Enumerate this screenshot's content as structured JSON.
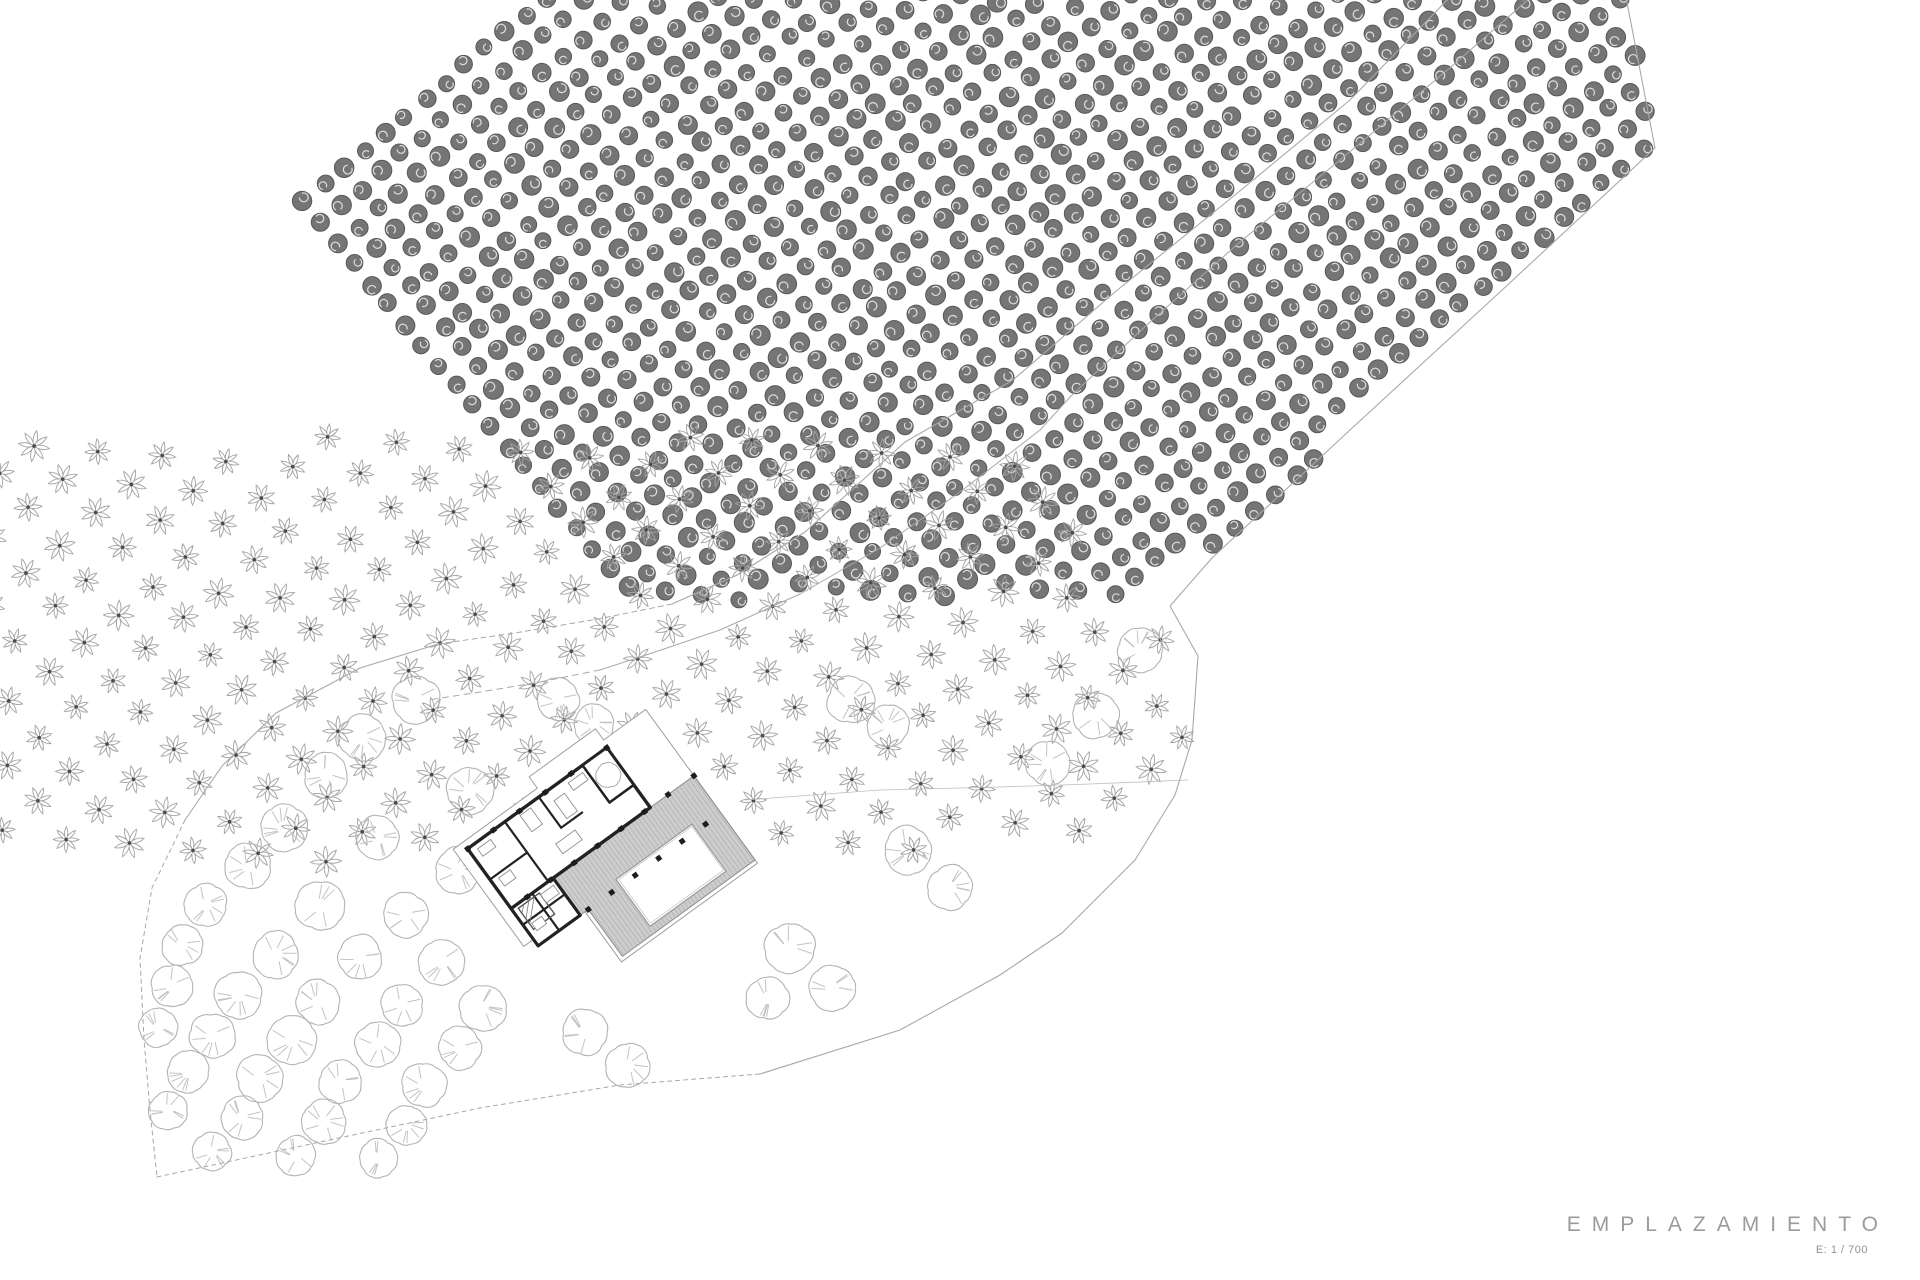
{
  "titleblock": {
    "title": "EMPLAZAMIENTO",
    "scale_label": "E: 1 / 700"
  },
  "drawing": {
    "canvas": {
      "width": 1920,
      "height": 1280,
      "background": "#ffffff"
    },
    "colors": {
      "boundary": "#a8a8a8",
      "road": "#a8a8a8",
      "fence": "#bdbdbd",
      "round_tree": "#b3b3b3",
      "round_tree_tick": "#c3c3c3",
      "flower_petal": "#a3a3a3",
      "flower_center": "#4a4a4a",
      "dark_tree_fill": "#757575",
      "dark_tree_stroke": "#585858",
      "dark_tree_texture": "#ffffff",
      "wall": "#222222",
      "plot_outline": "#9f9f9f",
      "deck_fill": "#cdcdcd",
      "deck_stripe": "#b7b7b7",
      "deck_edge": "#8a8a8a",
      "pool_edge": "#9a9a9a",
      "furniture": "#8f8f8f",
      "column": "#1d1d1d"
    },
    "site_boundary": {
      "solid_upper": [
        [
          1455,
          -8
        ],
        [
          1350,
          100
        ],
        [
          1235,
          195
        ],
        [
          1115,
          292
        ],
        [
          1013,
          380
        ],
        [
          905,
          442
        ],
        [
          805,
          532
        ],
        [
          737,
          575
        ],
        [
          672,
          604
        ]
      ],
      "dashed_mid": [
        [
          672,
          604
        ],
        [
          598,
          619
        ],
        [
          515,
          633
        ],
        [
          438,
          644
        ]
      ],
      "solid_blob_top": [
        [
          438,
          644
        ],
        [
          360,
          668
        ],
        [
          276,
          713
        ],
        [
          222,
          766
        ],
        [
          185,
          820
        ]
      ],
      "dashed_left": [
        [
          185,
          820
        ],
        [
          152,
          888
        ],
        [
          140,
          958
        ],
        [
          144,
          1040
        ],
        [
          150,
          1110
        ],
        [
          157,
          1177
        ]
      ],
      "dashed_bottom": [
        [
          157,
          1177
        ],
        [
          320,
          1142
        ],
        [
          480,
          1108
        ],
        [
          620,
          1085
        ],
        [
          760,
          1074
        ]
      ],
      "solid_right": [
        [
          760,
          1074
        ],
        [
          900,
          1030
        ],
        [
          1000,
          975
        ],
        [
          1062,
          933
        ],
        [
          1135,
          860
        ],
        [
          1175,
          795
        ],
        [
          1192,
          740
        ],
        [
          1198,
          656
        ],
        [
          1170,
          606
        ],
        [
          1212,
          558
        ],
        [
          1350,
          430
        ],
        [
          1500,
          292
        ],
        [
          1655,
          148
        ],
        [
          1625,
          -8
        ]
      ]
    },
    "road": {
      "lower_solid": [
        [
          1537,
          -8
        ],
        [
          1445,
          72
        ],
        [
          1340,
          160
        ],
        [
          1240,
          242
        ],
        [
          1150,
          322
        ],
        [
          1072,
          395
        ],
        [
          1040,
          430
        ],
        [
          960,
          492
        ],
        [
          880,
          548
        ],
        [
          800,
          594
        ],
        [
          720,
          630
        ],
        [
          655,
          652
        ],
        [
          600,
          670
        ]
      ],
      "lower_dashed": [
        [
          600,
          670
        ],
        [
          540,
          682
        ],
        [
          480,
          692
        ],
        [
          428,
          700
        ]
      ]
    },
    "fence_line": [
      [
        745,
        800
      ],
      [
        880,
        790
      ],
      [
        1000,
        787
      ],
      [
        1090,
        784
      ],
      [
        1188,
        780
      ]
    ],
    "orchards": [
      {
        "name": "dense-dark-grove",
        "symbol": "dark",
        "spacing": 26.5,
        "angle": -40,
        "radius": 9,
        "jitter": 2.5,
        "region": [
          [
            1537,
            -12
          ],
          [
            1625,
            -12
          ],
          [
            1658,
            148
          ],
          [
            1500,
            292
          ],
          [
            1350,
            430
          ],
          [
            1215,
            552
          ],
          [
            1108,
            600
          ],
          [
            1040,
            430
          ],
          [
            1072,
            395
          ],
          [
            1150,
            322
          ],
          [
            1240,
            242
          ],
          [
            1340,
            160
          ],
          [
            1445,
            72
          ]
        ]
      },
      {
        "name": "flowering-grove",
        "symbol": "flower",
        "spacing": 46,
        "angle": -40,
        "radius": 14,
        "jitter": 3,
        "region": [
          [
            1040,
            432
          ],
          [
            1100,
            588
          ],
          [
            1185,
            646
          ],
          [
            1186,
            738
          ],
          [
            1148,
            798
          ],
          [
            1050,
            845
          ],
          [
            920,
            862
          ],
          [
            800,
            856
          ],
          [
            745,
            826
          ],
          [
            700,
            778
          ],
          [
            640,
            718
          ],
          [
            560,
            690
          ],
          [
            545,
            660
          ],
          [
            620,
            640
          ],
          [
            700,
            612
          ],
          [
            780,
            582
          ],
          [
            860,
            548
          ],
          [
            950,
            500
          ]
        ]
      }
    ],
    "scattered_trees": [
      [
        416,
        700,
        32
      ],
      [
        362,
        738,
        30
      ],
      [
        326,
        775,
        28
      ],
      [
        470,
        790,
        30
      ],
      [
        284,
        828,
        30
      ],
      [
        378,
        838,
        26
      ],
      [
        248,
        866,
        28
      ],
      [
        458,
        870,
        30
      ],
      [
        206,
        905,
        26
      ],
      [
        320,
        906,
        32
      ],
      [
        406,
        915,
        28
      ],
      [
        182,
        945,
        24
      ],
      [
        276,
        955,
        30
      ],
      [
        360,
        958,
        28
      ],
      [
        442,
        962,
        30
      ],
      [
        172,
        986,
        26
      ],
      [
        238,
        995,
        30
      ],
      [
        318,
        1002,
        28
      ],
      [
        402,
        1005,
        26
      ],
      [
        482,
        1008,
        30
      ],
      [
        158,
        1028,
        22
      ],
      [
        212,
        1036,
        28
      ],
      [
        292,
        1040,
        32
      ],
      [
        378,
        1044,
        28
      ],
      [
        460,
        1048,
        26
      ],
      [
        188,
        1072,
        26
      ],
      [
        260,
        1078,
        30
      ],
      [
        340,
        1082,
        26
      ],
      [
        424,
        1085,
        28
      ],
      [
        168,
        1110,
        22
      ],
      [
        242,
        1118,
        26
      ],
      [
        324,
        1122,
        28
      ],
      [
        406,
        1125,
        24
      ],
      [
        212,
        1152,
        22
      ],
      [
        296,
        1156,
        24
      ],
      [
        378,
        1158,
        22
      ],
      [
        558,
        700,
        26
      ],
      [
        594,
        724,
        24
      ],
      [
        530,
        886,
        28
      ],
      [
        851,
        700,
        30
      ],
      [
        888,
        726,
        26
      ],
      [
        908,
        850,
        32
      ],
      [
        950,
        888,
        28
      ],
      [
        790,
        948,
        34
      ],
      [
        832,
        988,
        30
      ],
      [
        768,
        998,
        26
      ],
      [
        585,
        1032,
        30
      ],
      [
        628,
        1066,
        28
      ],
      [
        1140,
        650,
        28
      ],
      [
        1095,
        715,
        30
      ],
      [
        1048,
        763,
        28
      ]
    ],
    "building": {
      "cx": 602,
      "cy": 850,
      "rot": -36,
      "plot_outline": [
        [
          -120,
          -88
        ],
        [
          -16,
          -88
        ],
        [
          -16,
          -102
        ],
        [
          66,
          -102
        ],
        [
          66,
          -88
        ],
        [
          118,
          -88
        ],
        [
          118,
          102
        ],
        [
          -50,
          102
        ],
        [
          -50,
          32
        ],
        [
          -120,
          32
        ]
      ],
      "deck": [
        [
          -88,
          -6
        ],
        [
          118,
          -6
        ],
        [
          118,
          98
        ],
        [
          -46,
          98
        ],
        [
          -46,
          40
        ],
        [
          -88,
          40
        ]
      ],
      "pool": [
        [
          -6,
          32
        ],
        [
          88,
          32
        ],
        [
          88,
          90
        ],
        [
          -6,
          90
        ]
      ],
      "house": [
        [
          -108,
          -80
        ],
        [
          64,
          -80
        ],
        [
          64,
          -6
        ],
        [
          -108,
          -6
        ]
      ],
      "annex": [
        [
          -108,
          -6
        ],
        [
          -56,
          -6
        ],
        [
          -56,
          40
        ],
        [
          -108,
          40
        ]
      ],
      "patio": [
        [
          34,
          -80
        ],
        [
          64,
          -80
        ],
        [
          64,
          -34
        ],
        [
          34,
          -34
        ]
      ],
      "inner_walls": [
        [
          [
            -62,
            -80
          ],
          [
            -62,
            -6
          ]
        ],
        [
          [
            -20,
            -80
          ],
          [
            -20,
            -42
          ]
        ],
        [
          [
            -108,
            -42
          ],
          [
            -62,
            -42
          ]
        ],
        [
          [
            -20,
            -42
          ],
          [
            6,
            -42
          ]
        ],
        [
          [
            34,
            -34
          ],
          [
            64,
            -34
          ]
        ],
        [
          [
            -82,
            -6
          ],
          [
            -82,
            40
          ]
        ],
        [
          [
            -108,
            14
          ],
          [
            -56,
            14
          ]
        ]
      ],
      "column_rows": [
        {
          "y": -6,
          "xs": [
            -88,
            -59,
            -30,
            -1,
            28,
            57,
            86,
            118
          ]
        },
        {
          "y": 40,
          "xs": [
            -46,
            -17,
            12,
            41,
            70,
            99
          ]
        },
        {
          "y": -80,
          "xs": [
            -108,
            -76,
            -44,
            -12,
            20,
            64
          ]
        }
      ],
      "patio_tree": [
        49,
        -57,
        12
      ],
      "furniture": [
        [
          -100,
          -74,
          16,
          9
        ],
        [
          -46,
          -76,
          13,
          20
        ],
        [
          -10,
          -68,
          13,
          22
        ],
        [
          -100,
          -38,
          14,
          10
        ],
        [
          -76,
          0,
          16,
          10
        ],
        [
          -34,
          -32,
          24,
          12
        ],
        [
          12,
          -74,
          18,
          9
        ],
        [
          -100,
          18,
          12,
          9
        ]
      ],
      "hatch_square": [
        -102,
        -2,
        26,
        26
      ],
      "deck_stripe_step": 4
    }
  }
}
